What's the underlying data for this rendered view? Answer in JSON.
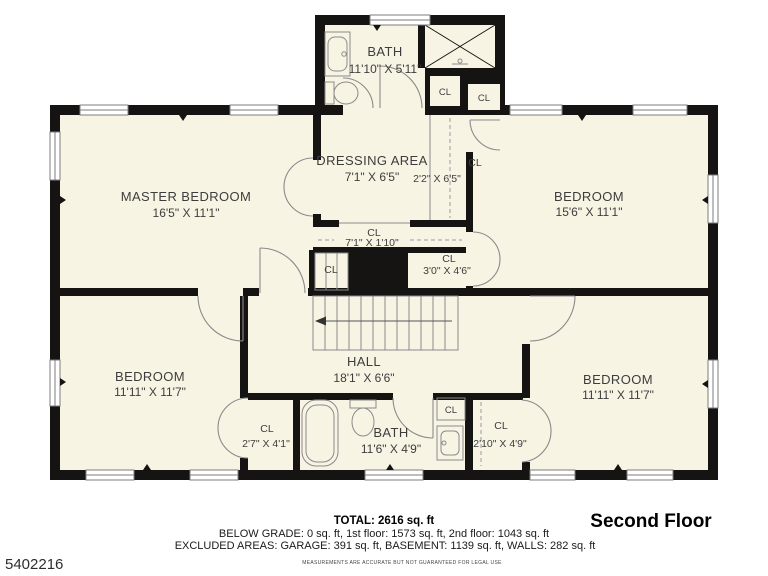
{
  "meta": {
    "photo_id": "5402216",
    "floor_title": "Second Floor"
  },
  "rooms": {
    "bath_top": {
      "name": "BATH",
      "dims": "11'10\" X 5'11\""
    },
    "master": {
      "name": "MASTER BEDROOM",
      "dims": "16'5\" X 11'1\""
    },
    "dressing": {
      "name": "DRESSING AREA",
      "dims": "7'1\" X 6'5\""
    },
    "bedroom_ne": {
      "name": "BEDROOM",
      "dims": "15'6\" X 11'1\""
    },
    "bedroom_sw": {
      "name": "BEDROOM",
      "dims": "11'11\" X 11'7\""
    },
    "bedroom_se": {
      "name": "BEDROOM",
      "dims": "11'11\" X 11'7\""
    },
    "hall": {
      "name": "HALL",
      "dims": "18'1\" X 6'6\""
    },
    "bath_bottom": {
      "name": "BATH",
      "dims": "11'6\" X 4'9\""
    }
  },
  "closets": {
    "cl_dressing": {
      "name": "CL",
      "dims": "2'2\" X 6'5\""
    },
    "cl_landing": {
      "name": "CL",
      "dims": "7'1\" X 1'10\""
    },
    "cl_ne": {
      "name": "CL",
      "dims": "3'0\" X 4'6\""
    },
    "cl_sw": {
      "name": "CL",
      "dims": "2'7\" X 4'1\""
    },
    "cl_se": {
      "name": "CL",
      "dims": "2'10\" X 4'9\""
    },
    "cl_bath_a": {
      "name": "CL"
    },
    "cl_bath_b": {
      "name": "CL"
    },
    "cl_stair": {
      "name": "CL"
    },
    "cl_linen": {
      "name": "CL"
    }
  },
  "summary": {
    "total": "TOTAL: 2616 sq. ft",
    "below_grade": "BELOW GRADE: 0 sq. ft, 1st floor: 1573 sq. ft, 2nd floor: 1043 sq. ft",
    "excluded": "EXCLUDED AREAS: GARAGE: 391 sq. ft, BASEMENT: 1139 sq. ft, WALLS: 282 sq. ft",
    "disclaimer": "MEASUREMENTS ARE ACCURATE BUT NOT GUARANTEED FOR LEGAL USE"
  },
  "colors": {
    "wall": "#161412",
    "floor": "#f8f4e4",
    "fixture_line": "#8a8a8a"
  }
}
